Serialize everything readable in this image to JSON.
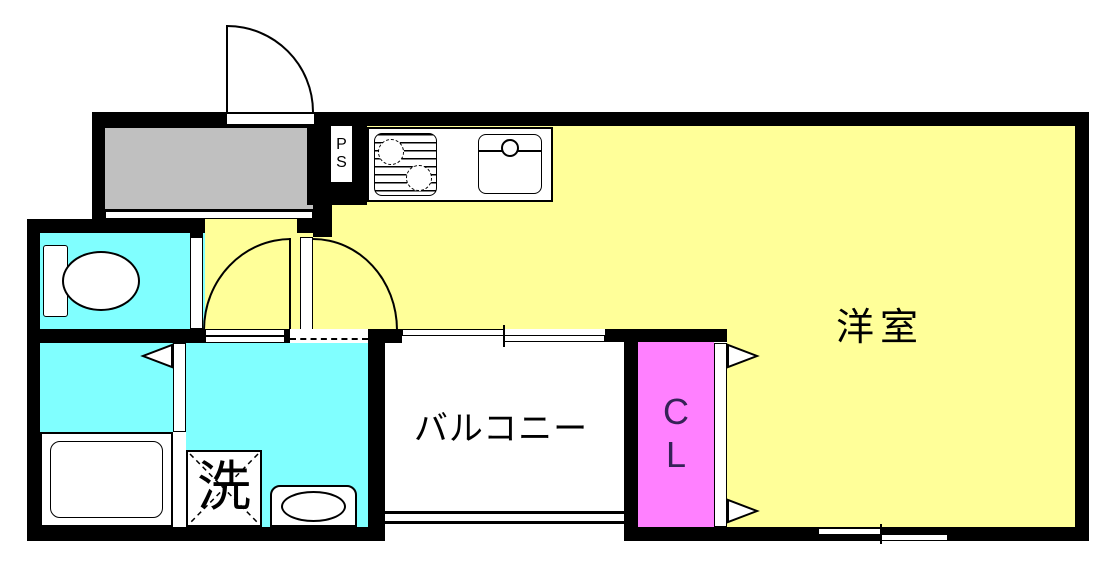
{
  "plan": {
    "type": "japanese-apartment-floor-plan",
    "labels": {
      "western_room": "洋室",
      "balcony": "バルコニー",
      "closet_line1": "C",
      "closet_line2": "L",
      "pipe_space_line1": "P",
      "pipe_space_line2": "S",
      "washer": "洗"
    },
    "colors": {
      "wall": "#000000",
      "room_yellow": "#ffff99",
      "wet_area_cyan": "#80ffff",
      "closet_pink": "#ff80ff",
      "entry_gray": "#c0c0c0",
      "closet_text": "#352257",
      "background": "#ffffff"
    },
    "icons": [
      "entry-door-swing-icon",
      "interior-door-swing-icon",
      "sliding-door-icon",
      "open-boundary-dashed-icon",
      "balcony-sliding-window-icon",
      "bedroom-sliding-window-icon",
      "balcony-railing-icon",
      "gas-stove-icon",
      "kitchen-sink-icon",
      "toilet-icon",
      "bathtub-icon",
      "washing-machine-icon",
      "wash-basin-icon",
      "folding-door-triangle-icon"
    ]
  }
}
